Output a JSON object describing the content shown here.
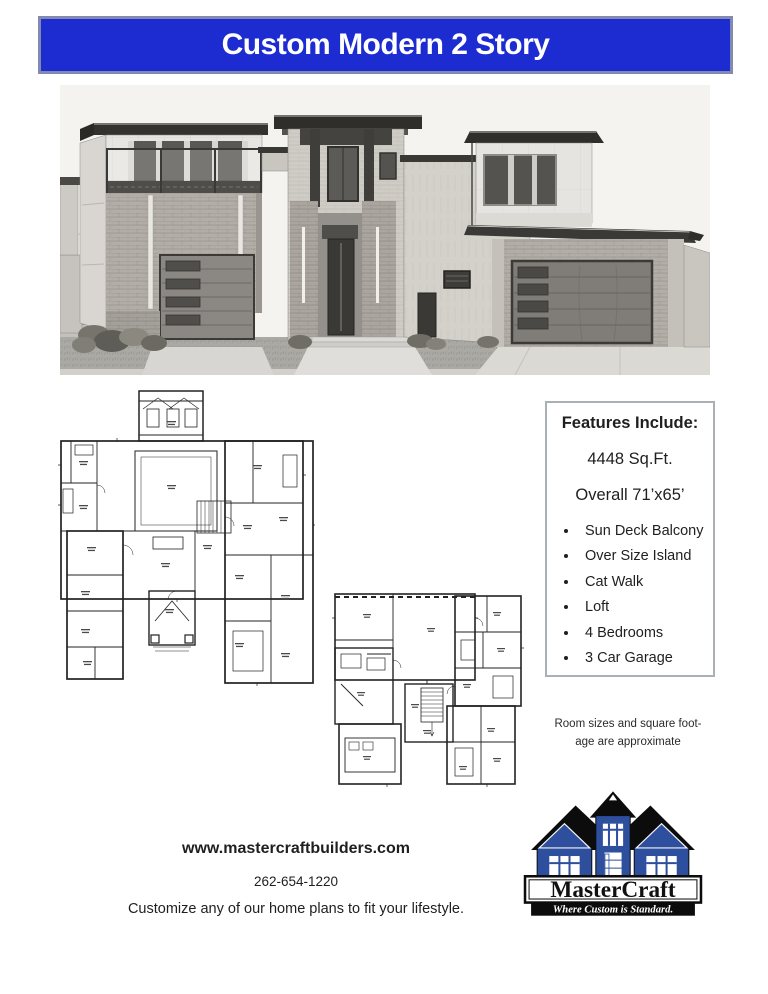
{
  "banner": {
    "title": "Custom Modern 2 Story"
  },
  "features": {
    "title": "Features Include:",
    "sqft": "4448 Sq.Ft.",
    "overall": "Overall 71’x65’",
    "items": [
      "Sun Deck Balcony",
      "Over Size Island",
      "Cat Walk",
      "Loft",
      "4 Bedrooms",
      "3 Car Garage"
    ]
  },
  "note": {
    "line1": "Room sizes and square foot-",
    "line2": "age are approximate"
  },
  "footer": {
    "website": "www.mastercraftbuilders.com",
    "phone": "262-654-1220",
    "tagline": "Customize any of our home plans to fit your lifestyle."
  },
  "logo": {
    "name": "MasterCraft",
    "slogan": "Where Custom is Standard.",
    "house_icon": "blue-house-icon"
  },
  "images": {
    "house_rendering": "grayscale pencil rendering of custom modern 2 story home",
    "plan1": "first floor plan drawing",
    "plan2": "second floor plan drawing"
  },
  "colors": {
    "banner_blue": "#1c2cd1",
    "banner_border": "#828aaf",
    "logo_blue": "#2d4f9e",
    "features_border": "#a9b1b5"
  }
}
